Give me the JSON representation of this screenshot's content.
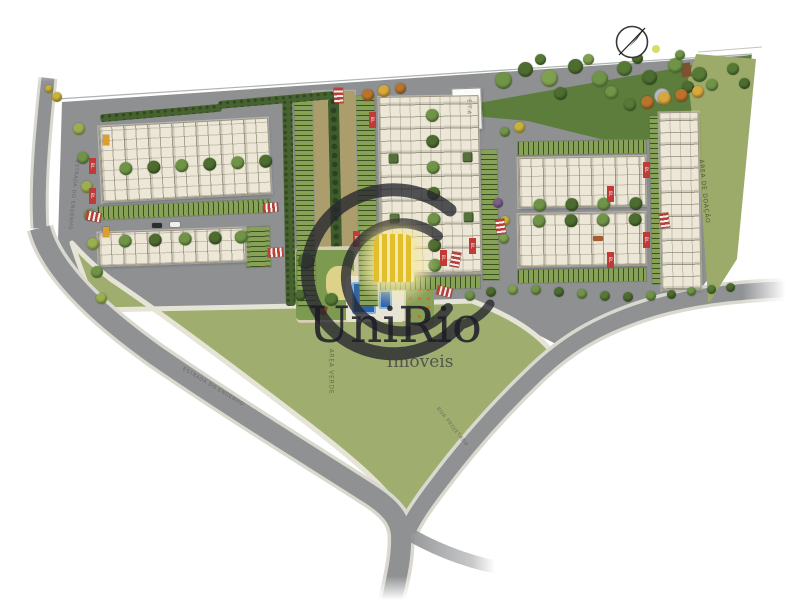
{
  "watermark": {
    "brand": "UniRio",
    "tagline": "Imóveis"
  },
  "compass": {
    "icon": "north-arrow"
  },
  "labels": {
    "donation_area": "ÁREA DE DOAÇÃO",
    "green_area": "ÁREA VERDE",
    "utility_building": "E.T.A",
    "road_left": "ESTRADA DO ENGENHO",
    "road_bottom": "ESTRADA DO ENGENHO",
    "road_diagonal": "RUA PROJETADA",
    "block_tag": "BL"
  },
  "colors": {
    "road": "#8f9193",
    "field": "#9fae6e",
    "park": "#5c7d3b",
    "building": "#ece7d6",
    "avenue": "#ab9d6c",
    "accent_red": "#b5413a",
    "brand_dark": "#26262e",
    "brand_yellow": "#e8c82f",
    "pool_blue": "#2f62a8"
  }
}
